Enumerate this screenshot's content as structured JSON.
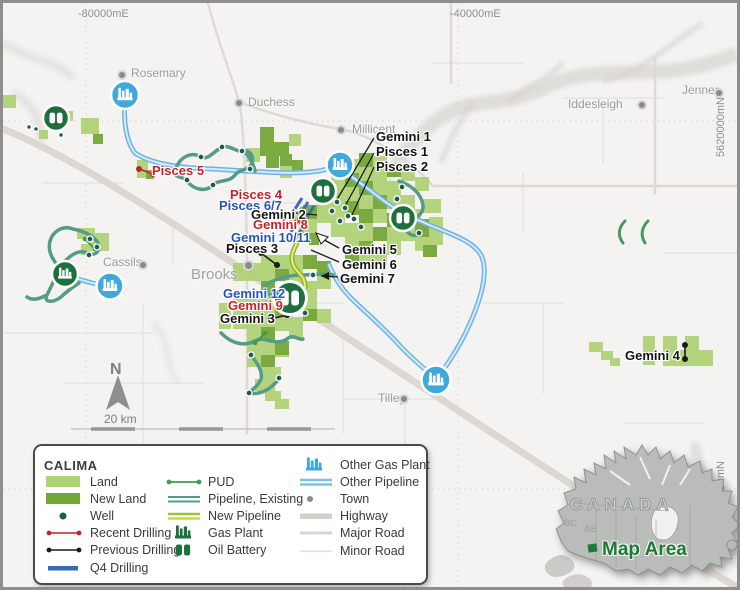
{
  "map": {
    "grid": {
      "top_left": "-80000mE",
      "top_right": "-40000mE",
      "right_upper": "5620000mN",
      "right_lower": "5580000mN"
    },
    "north_label": "N",
    "scale_label": "20 km",
    "towns": [
      {
        "name": "Rosemary",
        "x": 128,
        "y": 64,
        "dot_x": 116,
        "dot_y": 69
      },
      {
        "name": "Duchess",
        "x": 245,
        "y": 93,
        "dot_x": 233,
        "dot_y": 97
      },
      {
        "name": "Millicent",
        "x": 349,
        "y": 120,
        "dot_x": 335,
        "dot_y": 124
      },
      {
        "name": "Iddesleigh",
        "x": 565,
        "y": 95,
        "dot_x": 636,
        "dot_y": 99
      },
      {
        "name": "Jenner",
        "x": 679,
        "y": 81,
        "dot_x": 713,
        "dot_y": 87
      },
      {
        "name": "Cassils",
        "x": 100,
        "y": 253,
        "dot_x": 137,
        "dot_y": 259
      },
      {
        "name": "Brooks",
        "x": 188,
        "y": 266,
        "dot_x": 242,
        "dot_y": 259,
        "big": true
      },
      {
        "name": "Tilley",
        "x": 375,
        "y": 389,
        "dot_x": 398,
        "dot_y": 393
      }
    ],
    "well_labels": [
      {
        "name": "Gemini 1",
        "x": 373,
        "y": 127,
        "color": "black"
      },
      {
        "name": "Pisces 1",
        "x": 373,
        "y": 142,
        "color": "black"
      },
      {
        "name": "Pisces 2",
        "x": 373,
        "y": 157,
        "color": "black"
      },
      {
        "name": "Pisces 4",
        "x": 227,
        "y": 185,
        "color": "red"
      },
      {
        "name": "Pisces 6/7",
        "x": 216,
        "y": 196,
        "color": "blue"
      },
      {
        "name": "Gemini 2",
        "x": 248,
        "y": 205,
        "color": "black"
      },
      {
        "name": "Gemini 8",
        "x": 250,
        "y": 215,
        "color": "red"
      },
      {
        "name": "Gemini 10/11",
        "x": 228,
        "y": 228,
        "color": "blue"
      },
      {
        "name": "Pisces 3",
        "x": 223,
        "y": 239,
        "color": "black"
      },
      {
        "name": "Gemini 5",
        "x": 339,
        "y": 240,
        "color": "black"
      },
      {
        "name": "Gemini 6",
        "x": 339,
        "y": 255,
        "color": "black"
      },
      {
        "name": "Gemini 7",
        "x": 337,
        "y": 269,
        "color": "black"
      },
      {
        "name": "Gemini 12",
        "x": 220,
        "y": 284,
        "color": "blue"
      },
      {
        "name": "Gemini 9",
        "x": 225,
        "y": 296,
        "color": "red"
      },
      {
        "name": "Gemini 3",
        "x": 217,
        "y": 309,
        "color": "black"
      },
      {
        "name": "Gemini 4",
        "x": 622,
        "y": 346,
        "color": "black"
      },
      {
        "name": "Pisces 5",
        "x": 149,
        "y": 161,
        "color": "red"
      }
    ]
  },
  "legend": {
    "title": "CALIMA",
    "col1": [
      {
        "label": "Land"
      },
      {
        "label": "New Land"
      },
      {
        "label": "Well"
      },
      {
        "label": "Recent Drilling"
      },
      {
        "label": "Previous Drilling"
      },
      {
        "label": "Q4 Drilling"
      }
    ],
    "col2": [
      {
        "label": "PUD"
      },
      {
        "label": "Pipeline, Existing"
      },
      {
        "label": "New Pipeline"
      },
      {
        "label": "Gas Plant"
      },
      {
        "label": "Oil Battery"
      }
    ],
    "col3": [
      {
        "label": "Other Gas Plant"
      },
      {
        "label": "Other Pipeline"
      },
      {
        "label": "Town"
      },
      {
        "label": "Highway"
      },
      {
        "label": "Major Road"
      },
      {
        "label": "Minor Road"
      }
    ]
  },
  "inset": {
    "country": "CANADA",
    "bc": "BC",
    "ab": "AB",
    "map_area": "Map Area"
  },
  "colors": {
    "land": "#b0d176",
    "new_land": "#74a636",
    "well": "#1d5c4c",
    "recent_drilling": "#c5212b",
    "previous_drilling": "#1a1a1a",
    "q4_drilling": "#3a6cb4",
    "pud": "#3d9e4e",
    "pipeline_existing": "#569b87",
    "new_pipeline": "#d9e85c",
    "gas_plant": "#1e6f3e",
    "other_gas_plant": "#41a8db",
    "other_pipeline": "#c9e4f6",
    "map_area_green": "#1b7a3a"
  }
}
